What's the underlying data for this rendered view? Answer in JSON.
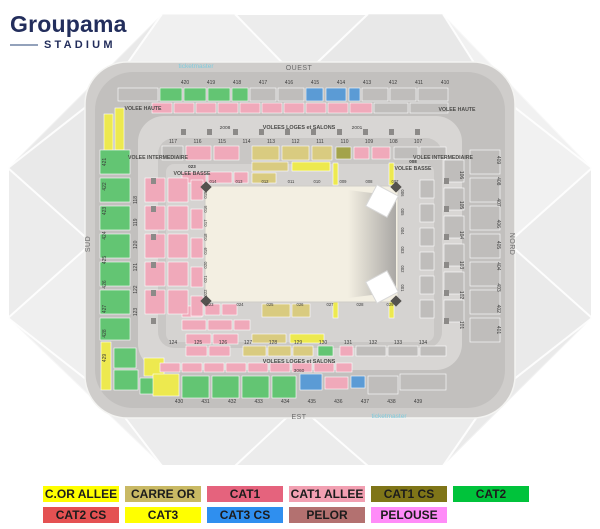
{
  "brand": {
    "name": "Groupama",
    "sub": "STADIUM"
  },
  "watermark": "ticketmaster",
  "compass": {
    "top": "OUEST",
    "right": "NORD",
    "bottom": "EST",
    "left": "SUD"
  },
  "stadium": {
    "tier_labels": {
      "haute": "VOLEE HAUTE",
      "inter": "VOLEE INTERMEDIAIRE",
      "basse": "VOLEE BASSE",
      "loges": "VOLEES LOGES et SALONS"
    },
    "basse_ids": {
      "left": "023",
      "right": "008"
    },
    "loges_top_ids": [
      "2008",
      "2001"
    ],
    "loges_bottom_ids": [
      "3060"
    ],
    "upper_top": [
      "420",
      "419",
      "418",
      "417",
      "416",
      "415",
      "414",
      "413",
      "412",
      "411",
      "410"
    ],
    "upper_left": [
      "421",
      "422",
      "423",
      "424",
      "425",
      "426",
      "427",
      "428",
      "429"
    ],
    "upper_right": [
      "409",
      "408",
      "407",
      "406",
      "405",
      "404",
      "403",
      "402",
      "401"
    ],
    "upper_bottom": [
      "430",
      "431",
      "432",
      "433",
      "434",
      "435",
      "436",
      "437",
      "438",
      "439"
    ],
    "ring_top": [
      "117",
      "116",
      "115",
      "114",
      "113",
      "112",
      "111",
      "110",
      "109",
      "108",
      "107"
    ],
    "ring_left": [
      "118",
      "119",
      "120",
      "121",
      "122",
      "123"
    ],
    "ring_right": [
      "106",
      "105",
      "104",
      "103",
      "102",
      "101"
    ],
    "ring_bottom": [
      "124",
      "125",
      "126",
      "127",
      "128",
      "129",
      "130",
      "131",
      "132",
      "133",
      "134"
    ],
    "pitch_top": [
      "014",
      "013",
      "012",
      "011",
      "010",
      "009",
      "008",
      "007"
    ],
    "pitch_left": [
      "015",
      "016",
      "017",
      "018",
      "019",
      "020",
      "021",
      "022"
    ],
    "pitch_bottom": [
      "023",
      "024",
      "025",
      "026",
      "027",
      "028",
      "029"
    ],
    "pitch_right": [
      "006",
      "005",
      "004",
      "003",
      "002",
      "001"
    ]
  },
  "legend": {
    "row_split": 6,
    "items": [
      {
        "label": "C.OR ALLEE",
        "color": "#FFFF00"
      },
      {
        "label": "CARRE OR",
        "color": "#C9B964"
      },
      {
        "label": "CAT1",
        "color": "#E5637D"
      },
      {
        "label": "CAT1 ALLEE",
        "color": "#F2A0B2"
      },
      {
        "label": "CAT1 CS",
        "color": "#7F7518"
      },
      {
        "label": "CAT2",
        "color": "#00C33B"
      },
      {
        "label": "CAT2 CS",
        "color": "#E45152"
      },
      {
        "label": "CAT3",
        "color": "#FFFF00"
      },
      {
        "label": "CAT3 CS",
        "color": "#2F8FEF"
      },
      {
        "label": "PELOR",
        "color": "#B37170"
      },
      {
        "label": "PELOUSE",
        "color": "#FF8BF8"
      }
    ]
  },
  "map_colors": {
    "cat1_pink": "#F0A9BA",
    "cat2_green": "#63C573",
    "cat3cs_blue": "#5B9BD5",
    "yellow": "#EDE94F",
    "carre_or": "#D9CB80",
    "cat1cs_olive": "#A3A34A",
    "gray_section": "#BFBDBB",
    "pitch": "#F3EFE2"
  }
}
